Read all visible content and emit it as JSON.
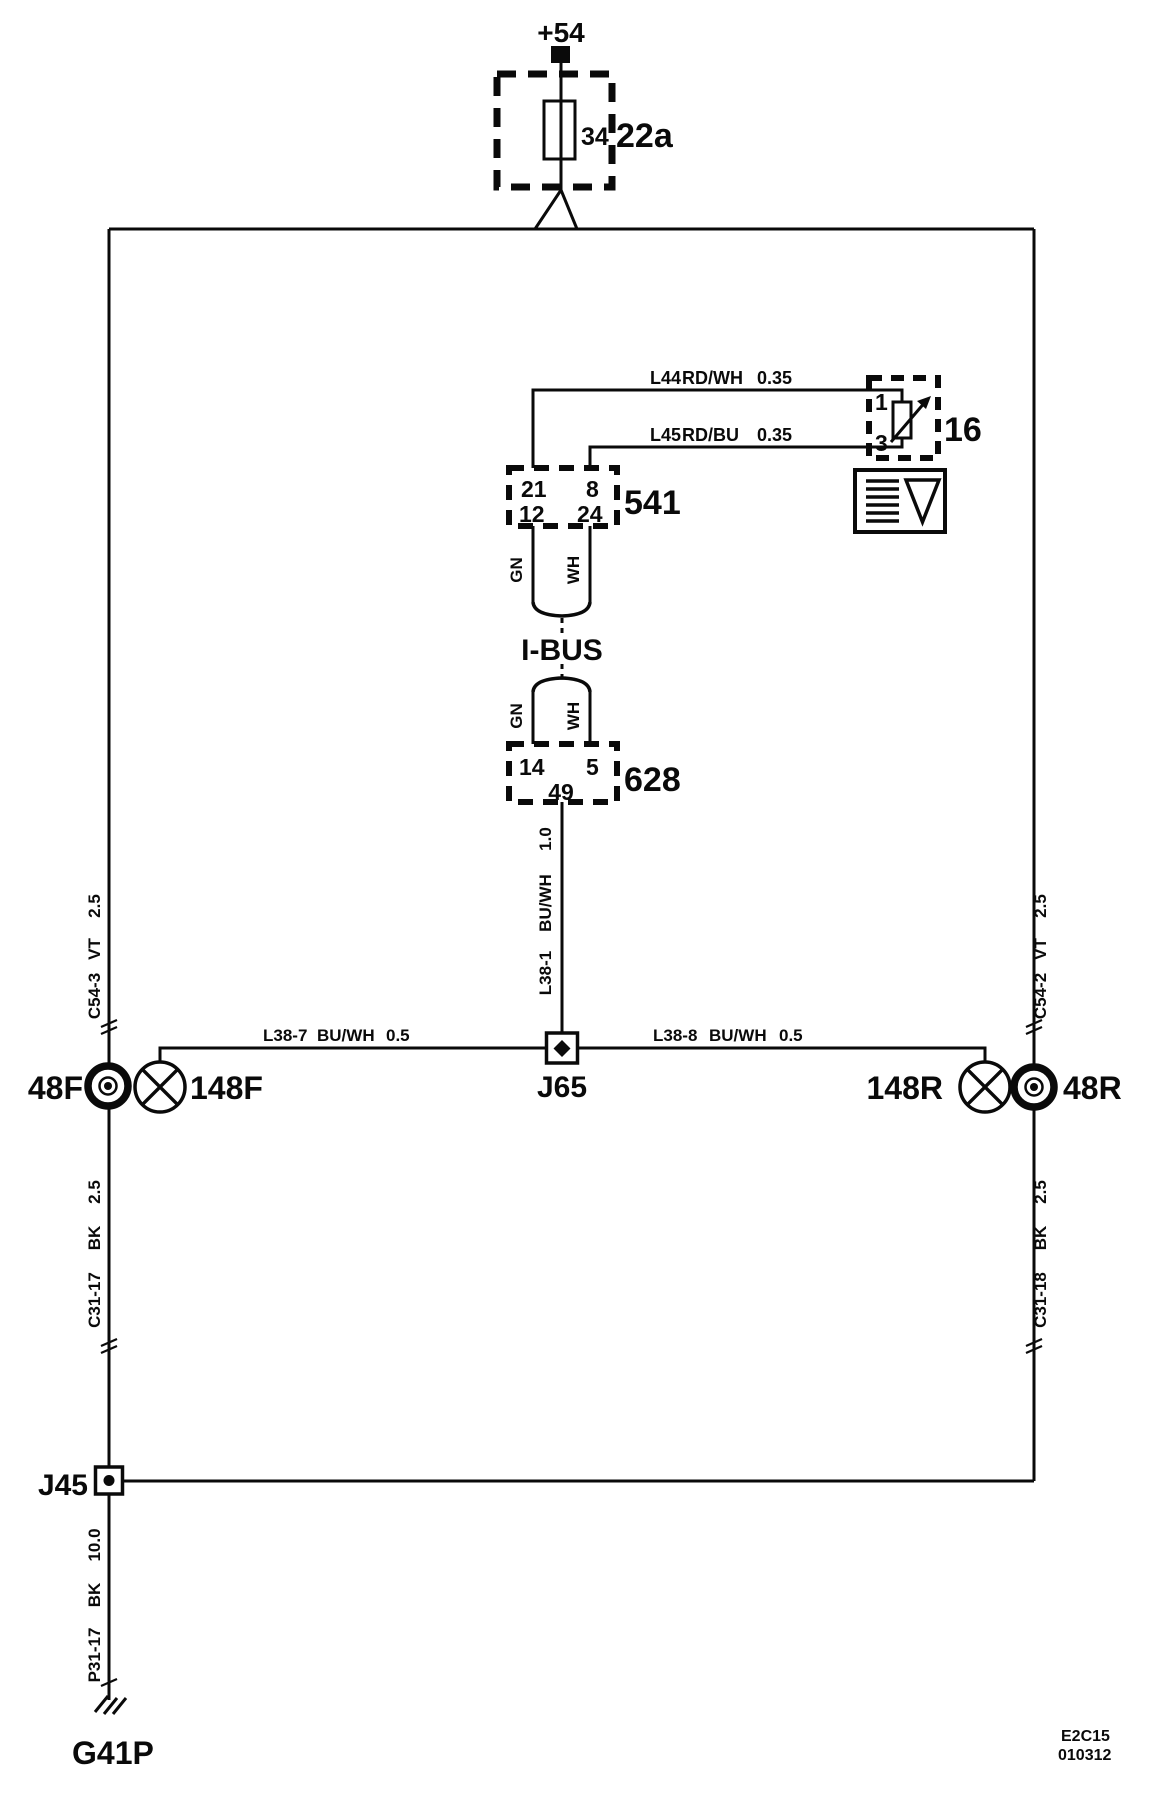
{
  "colors": {
    "ink": "#0a0a0a",
    "paper": "#ffffff"
  },
  "power_feed": {
    "terminal": "+54"
  },
  "fuse_box": {
    "component": "22a",
    "fuse": "34"
  },
  "rheostat": {
    "component": "16",
    "pin_top": "1",
    "pin_bottom": "3"
  },
  "module_541": {
    "component": "541",
    "pin_21": "21",
    "pin_8": "8",
    "pin_12": "12",
    "pin_24": "24"
  },
  "module_628": {
    "component": "628",
    "pin_14": "14",
    "pin_5": "5",
    "pin_49": "49"
  },
  "ibus": {
    "label": "I-BUS",
    "wire_green": "GN",
    "wire_white": "WH"
  },
  "wires": {
    "l44": {
      "id": "L44",
      "color": "RD/WH",
      "size": "0.35"
    },
    "l45": {
      "id": "L45",
      "color": "RD/BU",
      "size": "0.35"
    },
    "l38_1": {
      "id": "L38-1",
      "color": "BU/WH",
      "size": "1.0"
    },
    "l38_7": {
      "id": "L38-7",
      "color": "BU/WH",
      "size": "0.5"
    },
    "l38_8": {
      "id": "L38-8",
      "color": "BU/WH",
      "size": "0.5"
    },
    "c54_3": {
      "id": "C54-3",
      "color": "VT",
      "size": "2.5"
    },
    "c54_2": {
      "id": "C54-2",
      "color": "VT",
      "size": "2.5"
    },
    "c31_17": {
      "id": "C31-17",
      "color": "BK",
      "size": "2.5"
    },
    "c31_18": {
      "id": "C31-18",
      "color": "BK",
      "size": "2.5"
    },
    "p31_17": {
      "id": "P31-17",
      "color": "BK",
      "size": "10.0"
    }
  },
  "junctions": {
    "j65": "J65",
    "j45": "J45"
  },
  "terminals": {
    "front": "48F",
    "rear": "48R"
  },
  "lamps": {
    "front": "148F",
    "rear": "148R"
  },
  "ground": {
    "label": "G41P"
  },
  "footer": {
    "sheet": "E2C15",
    "date": "010312"
  }
}
